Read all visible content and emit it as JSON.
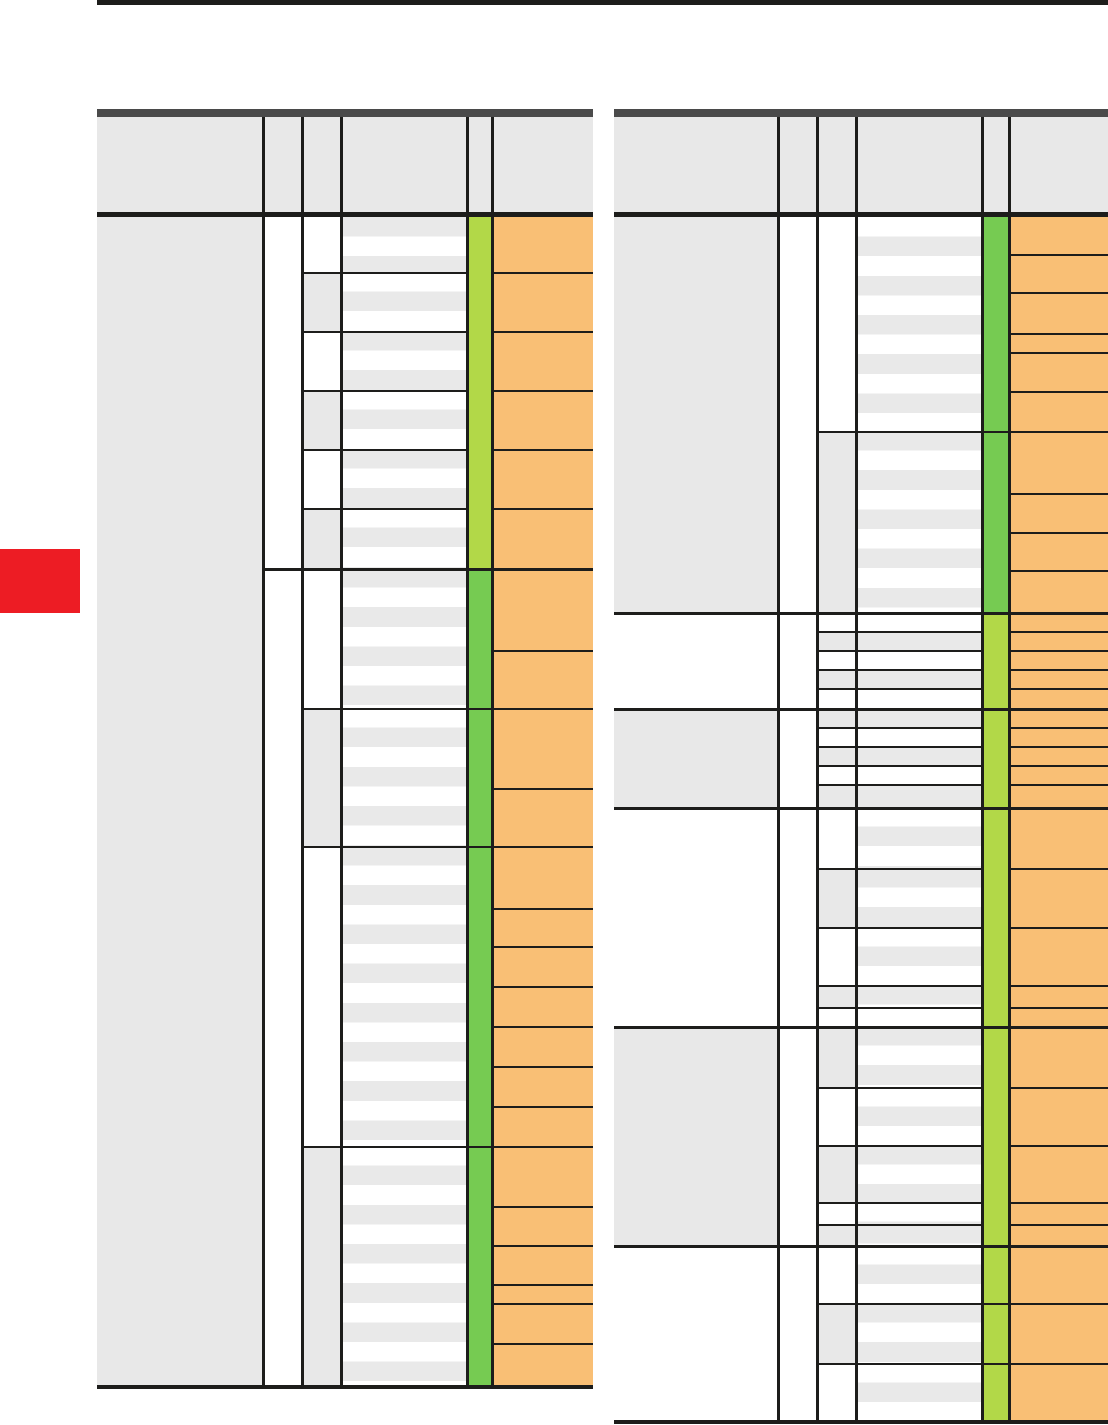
{
  "page": {
    "width": 1108,
    "height": 1425,
    "background": "#ffffff"
  },
  "colors": {
    "black": "#1d1d1b",
    "header_bar": "#4a4a4a",
    "cell_gray": "#e8e8e8",
    "stripe_gray": "#e9e9e9",
    "white": "#ffffff",
    "green_light": "#b2d848",
    "green_dark": "#76cb52",
    "orange": "#f9bf75",
    "red": "#ed1c24"
  },
  "stripe_height": 19.6,
  "top_rule": {
    "x": 97,
    "y": 0,
    "w": 1011,
    "h": 5
  },
  "red_tab": {
    "x": 0,
    "y": 549,
    "w": 80,
    "h": 64
  },
  "tables": [
    {
      "id": "table-left",
      "x": 97,
      "w": 496,
      "header": {
        "bar_y": 109,
        "bar_h": 8,
        "y": 117,
        "h": 95,
        "rule_y": 212,
        "rule_h": 5
      },
      "body_top": 217,
      "body_bottom": 1385,
      "bottom_rule_h": 4,
      "cols": {
        "c1_x": 97,
        "c1_w": 165,
        "c3_x": 304,
        "c3_w": 36,
        "c4_x": 343,
        "c4_w": 123,
        "c5_x": 469,
        "c5_w": 22,
        "c6_x": 494,
        "c6_w": 99
      },
      "verticals": [
        262,
        301,
        340,
        466,
        491
      ],
      "c1_cells": [
        [
          217,
          1385
        ]
      ],
      "group_lines": [
        [
          568,
          262,
          593
        ]
      ],
      "c3_blocks": [
        [
          217,
          272,
          "white",
          "gray"
        ],
        [
          272,
          331,
          "gray",
          "white"
        ],
        [
          331,
          390,
          "white",
          "gray"
        ],
        [
          390,
          449,
          "gray",
          "white"
        ],
        [
          449,
          508,
          "white",
          "gray"
        ],
        [
          508,
          568,
          "gray",
          "white"
        ],
        [
          568,
          708,
          "white",
          "gray"
        ],
        [
          708,
          846,
          "gray",
          "white"
        ],
        [
          846,
          1146,
          "white",
          "gray"
        ],
        [
          1146,
          1385,
          "gray",
          "white"
        ]
      ],
      "block_lines": [
        [
          272,
          301,
          469
        ],
        [
          331,
          301,
          469
        ],
        [
          390,
          301,
          469
        ],
        [
          449,
          301,
          469
        ],
        [
          508,
          301,
          469
        ],
        [
          708,
          301,
          494
        ],
        [
          846,
          301,
          494
        ],
        [
          1146,
          301,
          494
        ]
      ],
      "green_cells": [
        [
          217,
          568,
          "light"
        ],
        [
          568,
          1385,
          "dark"
        ]
      ],
      "orange_lines": [
        272,
        331,
        390,
        449,
        508,
        650,
        708,
        788,
        846,
        908,
        946,
        986,
        1026,
        1066,
        1106,
        1146,
        1206,
        1245,
        1284,
        1303,
        1343
      ]
    },
    {
      "id": "table-right",
      "x": 614,
      "w": 494,
      "header": {
        "bar_y": 109,
        "bar_h": 8,
        "y": 117,
        "h": 95,
        "rule_y": 212,
        "rule_h": 5
      },
      "body_top": 217,
      "body_bottom": 1420,
      "bottom_rule_h": 4,
      "cols": {
        "c1_x": 614,
        "c1_w": 163,
        "c3_x": 819,
        "c3_w": 36,
        "c4_x": 858,
        "c4_w": 123,
        "c5_x": 984,
        "c5_w": 24,
        "c6_x": 1011,
        "c6_w": 97
      },
      "verticals": [
        777,
        816,
        855,
        981,
        1008
      ],
      "c1_cells": [
        [
          217,
          612
        ],
        [
          708,
          807
        ],
        [
          1026,
          1245
        ]
      ],
      "group_lines": [
        [
          612,
          614,
          1108
        ],
        [
          708,
          614,
          1108
        ],
        [
          807,
          614,
          1108
        ],
        [
          1026,
          614,
          1108
        ],
        [
          1245,
          614,
          1108
        ]
      ],
      "c3_blocks": [
        [
          217,
          431,
          "white",
          "white"
        ],
        [
          431,
          612,
          "gray",
          "gray"
        ],
        [
          612,
          631,
          "white",
          "solid"
        ],
        [
          631,
          650,
          "gray",
          "solid"
        ],
        [
          650,
          669,
          "white",
          "solid"
        ],
        [
          669,
          688,
          "gray",
          "solid"
        ],
        [
          688,
          708,
          "white",
          "solid"
        ],
        [
          708,
          727,
          "gray",
          "solid"
        ],
        [
          727,
          746,
          "white",
          "solid"
        ],
        [
          746,
          765,
          "gray",
          "solid"
        ],
        [
          765,
          784,
          "white",
          "solid"
        ],
        [
          784,
          807,
          "gray",
          "solid"
        ],
        [
          807,
          868,
          "white",
          "white"
        ],
        [
          868,
          927,
          "gray",
          "gray"
        ],
        [
          927,
          985,
          "white",
          "white"
        ],
        [
          985,
          1007,
          "gray",
          "gray"
        ],
        [
          1007,
          1026,
          "white",
          "white"
        ],
        [
          1026,
          1087,
          "gray",
          "gray"
        ],
        [
          1087,
          1145,
          "white",
          "white"
        ],
        [
          1145,
          1202,
          "gray",
          "gray"
        ],
        [
          1202,
          1224,
          "white",
          "white"
        ],
        [
          1224,
          1245,
          "gray",
          "gray"
        ],
        [
          1245,
          1303,
          "white",
          "white"
        ],
        [
          1303,
          1363,
          "gray",
          "gray"
        ],
        [
          1363,
          1420,
          "white",
          "white"
        ]
      ],
      "block_lines": [
        [
          431,
          816,
          1011
        ],
        [
          631,
          816,
          984
        ],
        [
          650,
          816,
          984
        ],
        [
          669,
          816,
          984
        ],
        [
          688,
          816,
          984
        ],
        [
          727,
          816,
          984
        ],
        [
          746,
          816,
          984
        ],
        [
          765,
          816,
          984
        ],
        [
          784,
          816,
          984
        ],
        [
          868,
          816,
          984
        ],
        [
          927,
          816,
          984
        ],
        [
          985,
          816,
          984
        ],
        [
          1007,
          816,
          984
        ],
        [
          1087,
          816,
          984
        ],
        [
          1145,
          816,
          984
        ],
        [
          1202,
          816,
          984
        ],
        [
          1224,
          816,
          984
        ],
        [
          1303,
          816,
          1011
        ],
        [
          1363,
          816,
          1011
        ]
      ],
      "green_cells": [
        [
          217,
          612,
          "dark"
        ],
        [
          612,
          1420,
          "light"
        ]
      ],
      "orange_lines": [
        254,
        292,
        333,
        352,
        391,
        431,
        493,
        532,
        570,
        631,
        650,
        669,
        688,
        727,
        746,
        765,
        784,
        868,
        927,
        985,
        1007,
        1087,
        1145,
        1202,
        1224,
        1303,
        1363
      ]
    }
  ]
}
